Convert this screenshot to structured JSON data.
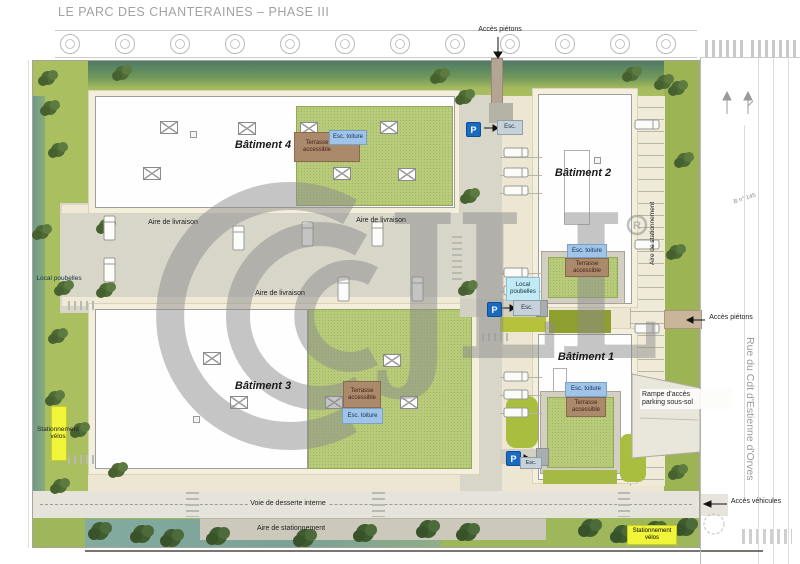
{
  "title": "LE PARC DES CHANTERAINES – PHASE III",
  "watermark": {
    "text": "JLL",
    "r": "R"
  },
  "streets": {
    "rue": "Rue du Cdt d'Estienne d'Orves",
    "parcelle": "B n° 145"
  },
  "buildings": {
    "b1": {
      "name": "Bâtiment 1"
    },
    "b2": {
      "name": "Bâtiment 2"
    },
    "b3": {
      "name": "Bâtiment 3"
    },
    "b4": {
      "name": "Bâtiment 4"
    }
  },
  "ann": {
    "acces_pietons": "Accès piétons",
    "acces_vehicules": "Accès véhicules",
    "aire_livraison": "Aire de livraison",
    "aire_stationnement": "Aire de stationnement",
    "voie_desserte": "Voie de desserte interne",
    "rampe_l1": "Rampe d'accès",
    "rampe_l2": "parking sous-sol",
    "local_poubelles": "Local poubelles",
    "esc": "Esc.",
    "esc_toiture": "Esc. toiture",
    "terrasse": "Terrasse accessible",
    "stationnement_velos": "Stationnement vélos",
    "p": "P"
  },
  "colors": {
    "parking_blue": "#1a6ac0",
    "roof_green": "#b7cb7a",
    "terrace_brown": "#ab8a6b",
    "esc_blue": "#9fc4e8",
    "poubelles_cyan": "#c2eaf4",
    "velos_yellow": "#f1f53a",
    "water_teal": "#7fa699",
    "watermark_grey": "#8c8c8c"
  }
}
